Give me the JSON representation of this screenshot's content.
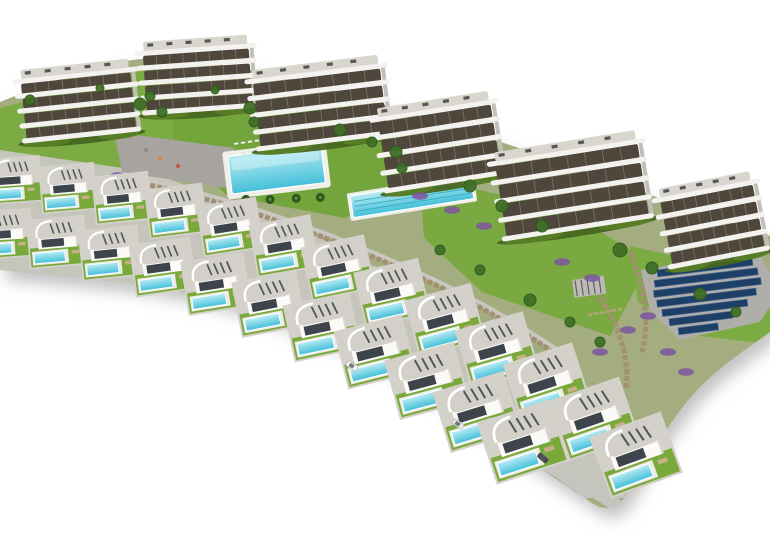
{
  "scene": {
    "description": "aerial-3d-architectural-render-residential-complex-with-villas-pools-and-apartment-blocks",
    "canvas": {
      "width": 770,
      "height": 535
    },
    "background": "#ffffff",
    "palette": {
      "base": "#a4ad7f",
      "villa_band": "#c8c6c0",
      "lawn": "#7cab44",
      "lawn2": "#74a53c",
      "lawn3": "#79a940",
      "plaza": "#a7a4a0",
      "walkway": "#c9c7c1",
      "wall": "#a38f72",
      "deck": "#efeee8",
      "water_light": "#b8ecf4",
      "water": "#43bfd9",
      "lane": "#35aabf",
      "building_white": "#f3f2ee",
      "building_dark": "#4f473c",
      "building_side": "#c2bfb8",
      "roof_deck": "#d9d6ce",
      "roof_item": "#3d4146",
      "villa_wall": "#fbfaf7",
      "villa_shade": "#d9d7d0",
      "villa_roof": "#d2d0c8",
      "villa_window": "#3e444b",
      "villa_pad": "#d3d1ca",
      "villa_lawn": "#79a93a",
      "villa_deck": "#eceae4",
      "furniture": "#c7b089",
      "hedge": "#47671f",
      "hedge2": "#5a8028",
      "tree": "#3f7026",
      "tree_dark": "#2e5a1c",
      "shrub": "#7d55a0",
      "solar": "#1e3f66",
      "solar_edge": "#4a6e9b",
      "solar_pad": "#b0aea9",
      "pergola": "#bdbbb4",
      "road": "#c6c4be",
      "car_dark": "#43474d",
      "car_light": "#f4f4f2",
      "car_silver": "#e8e7e4",
      "lounger_white": "#ffffff",
      "lounger_tan": "#c19a62",
      "shadow": "#8f8f8f"
    },
    "site_outline": "M0,102 C60,78 110,58 162,58 C240,62 320,86 400,110 C480,134 562,162 642,192 C702,214 746,226 770,236 L770,332 C742,352 712,372 690,398 C666,426 644,466 624,498 C612,514 597,508 585,498 C542,470 482,428 422,384 C342,338 242,300 152,286 C96,278 40,274 0,270 Z",
    "villa_band_points": "0,150 150,172 300,228 440,300 560,380 636,462 624,498 585,498 422,384 242,300 152,286 0,270",
    "lawns": [
      {
        "points": "0,108 160,66 210,118 168,172 60,188 0,178",
        "fill": "lawn"
      },
      {
        "points": "170,96 350,108 430,178 345,218 228,196 175,146",
        "fill": "lawn2"
      },
      {
        "points": "420,176 565,210 650,262 610,336 482,292 424,238",
        "fill": "lawn3"
      },
      {
        "points": "630,246 770,278 770,344 700,336 638,302",
        "fill": "lawn"
      }
    ],
    "plaza": {
      "points": "114,132 234,148 226,188 122,172",
      "dots": [
        [
          160,
          158,
          "#d98736"
        ],
        [
          178,
          166,
          "#c5524a"
        ],
        [
          146,
          150,
          "#8a8a88"
        ]
      ]
    },
    "walkway": {
      "d": "M116,174 C228,196 338,234 438,282 C492,308 538,336 574,362",
      "width": 5
    },
    "walls": [
      {
        "d": "M116,178 C228,200 338,238 438,286 C492,312 538,340 572,366"
      },
      {
        "d": "M630,252 C645,290 650,322 642,352"
      },
      {
        "d": "M596,292 C618,322 630,356 626,388"
      }
    ],
    "communal_pool": {
      "x": 222,
      "y": 152,
      "rot": -7,
      "deck": [
        0,
        0,
        104,
        48
      ],
      "water": [
        5,
        5,
        94,
        38
      ],
      "palms": [
        [
          18,
          50
        ],
        [
          42,
          53
        ],
        [
          68,
          55
        ],
        [
          92,
          57
        ]
      ]
    },
    "lap_pool": {
      "x": 350,
      "y": 196,
      "rot": -9,
      "deck": [
        -3,
        -3,
        128,
        28
      ],
      "water": [
        0,
        0,
        122,
        22
      ],
      "lanes": [
        6,
        11,
        16
      ]
    },
    "solar_array": {
      "x": 640,
      "y": 264,
      "rot": -7,
      "pad": "0,6 118,0 136,44 112,72 30,80 4,46",
      "rows": [
        [
          16,
          8,
          96
        ],
        [
          12,
          18,
          104
        ],
        [
          10,
          28,
          108
        ],
        [
          12,
          38,
          100
        ],
        [
          16,
          48,
          86
        ],
        [
          22,
          58,
          64
        ],
        [
          30,
          68,
          40
        ]
      ],
      "row_h": 7
    },
    "pergola": {
      "x": 572,
      "y": 280,
      "rot": -8,
      "w": 32,
      "h": 18
    },
    "loungers": [
      {
        "x": 234,
        "y": 143,
        "n": 11,
        "step": 7,
        "rot": -8,
        "color": "lounger_white"
      },
      {
        "x": 242,
        "y": 153,
        "n": 9,
        "step": 7,
        "rot": -8,
        "color": "lounger_white"
      },
      {
        "x": 588,
        "y": 314,
        "n": 6,
        "step": 6,
        "rot": -10,
        "color": "lounger_tan"
      }
    ],
    "buildings": [
      {
        "x": 24,
        "y": 142,
        "w": 116,
        "floors": 4,
        "fh": 15,
        "rot": -6
      },
      {
        "x": 144,
        "y": 114,
        "w": 112,
        "floors": 4,
        "fh": 15,
        "rot": -4
      },
      {
        "x": 258,
        "y": 150,
        "w": 134,
        "floors": 4,
        "fh": 17,
        "rot": -7
      },
      {
        "x": 386,
        "y": 192,
        "w": 120,
        "floors": 4,
        "fh": 18,
        "rot": -9
      },
      {
        "x": 504,
        "y": 240,
        "w": 150,
        "floors": 4,
        "fh": 19,
        "rot": -9
      },
      {
        "x": 670,
        "y": 268,
        "w": 100,
        "floors": 4,
        "fh": 17,
        "rot": -11
      }
    ],
    "villas": {
      "back": [
        {
          "x": 14,
          "y": 180,
          "s": 0.8,
          "r": -4
        },
        {
          "x": 68,
          "y": 188,
          "s": 0.82,
          "r": -5
        },
        {
          "x": 122,
          "y": 198,
          "s": 0.84,
          "r": -6
        },
        {
          "x": 176,
          "y": 211,
          "s": 0.86,
          "r": -7
        },
        {
          "x": 230,
          "y": 227,
          "s": 0.89,
          "r": -9
        },
        {
          "x": 284,
          "y": 246,
          "s": 0.92,
          "r": -10
        },
        {
          "x": 338,
          "y": 268,
          "s": 0.95,
          "r": -12
        },
        {
          "x": 392,
          "y": 293,
          "s": 0.98,
          "r": -13
        },
        {
          "x": 445,
          "y": 320,
          "s": 1.01,
          "r": -15
        },
        {
          "x": 497,
          "y": 350,
          "s": 1.04,
          "r": -16
        },
        {
          "x": 547,
          "y": 383,
          "s": 1.07,
          "r": -18
        },
        {
          "x": 594,
          "y": 419,
          "s": 1.1,
          "r": -19
        },
        {
          "x": 636,
          "y": 455,
          "s": 1.12,
          "r": -20
        }
      ],
      "front": [
        {
          "x": 4,
          "y": 234,
          "s": 0.84,
          "r": -4
        },
        {
          "x": 57,
          "y": 242,
          "s": 0.86,
          "r": -5
        },
        {
          "x": 110,
          "y": 253,
          "s": 0.88,
          "r": -6
        },
        {
          "x": 163,
          "y": 267,
          "s": 0.91,
          "r": -8
        },
        {
          "x": 216,
          "y": 284,
          "s": 0.94,
          "r": -9
        },
        {
          "x": 269,
          "y": 304,
          "s": 0.97,
          "r": -11
        },
        {
          "x": 322,
          "y": 327,
          "s": 1.0,
          "r": -12
        },
        {
          "x": 375,
          "y": 352,
          "s": 1.03,
          "r": -14
        },
        {
          "x": 427,
          "y": 381,
          "s": 1.06,
          "r": -15
        },
        {
          "x": 477,
          "y": 412,
          "s": 1.09,
          "r": -17
        },
        {
          "x": 523,
          "y": 442,
          "s": 1.12,
          "r": -18
        }
      ]
    },
    "road": {
      "d": "M-6,280 C150,296 310,342 440,408 C520,450 578,480 618,506",
      "width": 13
    },
    "cars": [
      {
        "x": 352,
        "y": 366,
        "rot": 32,
        "color": "car_light"
      },
      {
        "x": 458,
        "y": 424,
        "rot": 36,
        "color": "car_silver"
      },
      {
        "x": 543,
        "y": 458,
        "rot": 40,
        "color": "car_dark"
      }
    ],
    "trees": [
      [
        30,
        100,
        5
      ],
      [
        100,
        88,
        4
      ],
      [
        150,
        96,
        5
      ],
      [
        140,
        104,
        6
      ],
      [
        162,
        112,
        5
      ],
      [
        215,
        90,
        4
      ],
      [
        250,
        108,
        6
      ],
      [
        254,
        122,
        5
      ],
      [
        340,
        130,
        6
      ],
      [
        372,
        142,
        5
      ],
      [
        396,
        152,
        6
      ],
      [
        402,
        168,
        5
      ],
      [
        470,
        186,
        6
      ],
      [
        502,
        206,
        6
      ],
      [
        542,
        226,
        6
      ],
      [
        620,
        250,
        7
      ],
      [
        652,
        268,
        6
      ],
      [
        700,
        294,
        6
      ],
      [
        736,
        312,
        5
      ],
      [
        440,
        250,
        5
      ],
      [
        480,
        270,
        5
      ],
      [
        530,
        300,
        6
      ],
      [
        570,
        322,
        5
      ],
      [
        600,
        342,
        5
      ]
    ],
    "shrubs": [
      [
        118,
        176
      ],
      [
        140,
        190
      ],
      [
        190,
        204
      ],
      [
        240,
        222
      ],
      [
        290,
        243
      ],
      [
        340,
        266
      ],
      [
        390,
        292
      ],
      [
        436,
        318
      ],
      [
        480,
        345
      ],
      [
        360,
        262
      ],
      [
        376,
        272
      ],
      [
        392,
        284
      ],
      [
        520,
        368
      ],
      [
        556,
        394
      ],
      [
        600,
        352
      ],
      [
        628,
        330
      ],
      [
        648,
        316
      ],
      [
        420,
        196
      ],
      [
        452,
        210
      ],
      [
        484,
        226
      ],
      [
        562,
        262
      ],
      [
        592,
        278
      ],
      [
        668,
        352
      ],
      [
        686,
        372
      ]
    ]
  }
}
